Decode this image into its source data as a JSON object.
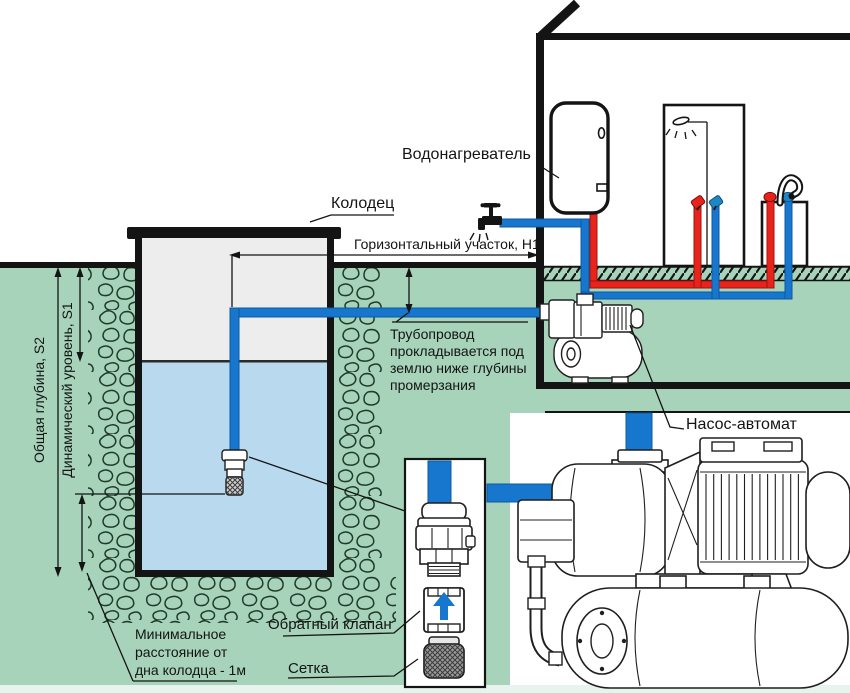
{
  "labels": {
    "well": "Колодец",
    "water_heater": "Водонагреватель",
    "horizontal_section": "Горизонтальный участок, H1",
    "pump_auto": "Насос-автомат",
    "total_depth": "Общая глубина, S2",
    "dynamic_level": "Динамический уровень, S1",
    "check_valve": "Обратный клапан",
    "mesh": "Сетка",
    "pipeline_note_lines": [
      "Трубопровод",
      "прокладывается под",
      "землю ниже глубины",
      "промерзания"
    ],
    "min_distance_lines": [
      "Минимальное",
      "расстояние от",
      "дна колодца - 1м"
    ]
  },
  "icons": {
    "outdoor_tap": "faucet-icon",
    "shower_head": "shower-head-icon",
    "sink_faucet": "faucet-icon",
    "check_valve_flow": "arrow-up-icon"
  },
  "colors": {
    "ground": "#a6d3b9",
    "water": "#b9d9ee",
    "well_interior": "#ededed",
    "pipe_blue": "#1777cf",
    "pipe_red": "#e8231c",
    "line": "#141414",
    "footer_strip": "#e7f3ec"
  }
}
